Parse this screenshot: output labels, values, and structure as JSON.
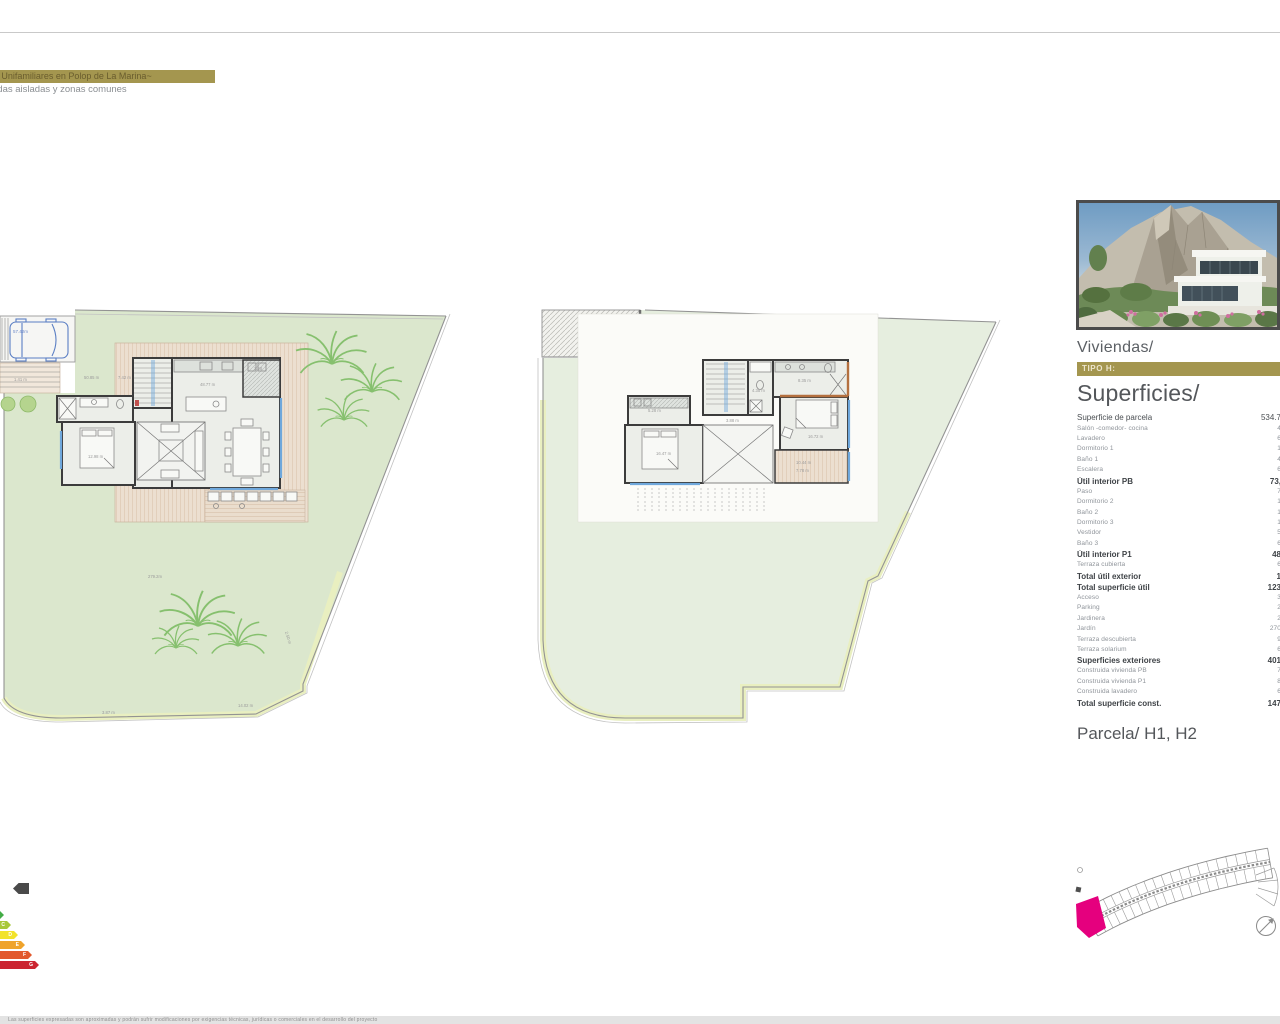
{
  "header": {
    "line1": "Viviendas Unifamiliares en Polop de La Marina~",
    "line2": "viviendas  aisladas y zonas comunes"
  },
  "panel": {
    "viviendas": "Viviendas/",
    "tipo": "TIPO H:",
    "superficies": "Superficies/",
    "parcela": "Parcela/ H1, H2",
    "rows": [
      {
        "label": "Superficie de parcela",
        "value": "534.7"
      },
      {
        "label": "Salón -comedor- cocina",
        "value": "4"
      },
      {
        "label": "Lavadero",
        "value": "6"
      },
      {
        "label": "Dormitorio 1",
        "value": "1"
      },
      {
        "label": "Baño 1",
        "value": "4"
      },
      {
        "label": "Escalera",
        "value": "6"
      },
      {
        "label": "Útil interior PB",
        "value": "73,"
      },
      {
        "label": "Paso",
        "value": "7"
      },
      {
        "label": "Dormitorio 2",
        "value": "1"
      },
      {
        "label": "Baño 2",
        "value": "1"
      },
      {
        "label": "Dormitorio 3",
        "value": "1"
      },
      {
        "label": "Vestidor",
        "value": "5"
      },
      {
        "label": "Baño 3",
        "value": "6"
      },
      {
        "label": "Útil interior P1",
        "value": "48"
      },
      {
        "label": "Terraza cubierta",
        "value": "6"
      },
      {
        "label": "Total útil exterior",
        "value": "1"
      },
      {
        "label": "Total superficie útil",
        "value": "123"
      },
      {
        "label": "Acceso",
        "value": "3"
      },
      {
        "label": "Parking",
        "value": "2"
      },
      {
        "label": "Jardinera",
        "value": "2"
      },
      {
        "label": "Jardín",
        "value": "270"
      },
      {
        "label": "Terraza descubierta",
        "value": "9"
      },
      {
        "label": "Terraza solarium",
        "value": "6"
      },
      {
        "label": "Superficies exteriores",
        "value": "401"
      },
      {
        "label": "Construida vivienda PB",
        "value": "7"
      },
      {
        "label": "Construida vivienda P1",
        "value": "8"
      },
      {
        "label": "Construida lavadero",
        "value": "6"
      },
      {
        "label": "Total superficie const.",
        "value": "147"
      }
    ]
  },
  "plans": {
    "pb": {
      "name": "planta-baja",
      "labels": [
        "57.42m",
        "1.41 m",
        "50.85 m",
        "7.42 m",
        "3.28",
        "48.77 m",
        "12.98 m",
        "279.2m",
        "2.50 m",
        "3.87 m",
        "14.02 m"
      ]
    },
    "p1": {
      "name": "planta-primera",
      "labels": [
        "5.28 m",
        "4.35 m",
        "8.35 m",
        "3.88 m",
        "16.47 m",
        "16.72 m",
        "10.44 m",
        "7.78 m"
      ]
    }
  },
  "energy": {
    "letters": [
      "B",
      "C",
      "D",
      "E",
      "F",
      "G"
    ],
    "colors": [
      "#42ac46",
      "#a8c83b",
      "#f2e32b",
      "#efa32b",
      "#e2582c",
      "#cb2430"
    ],
    "indicator_color": "#4a4a4a"
  },
  "colors": {
    "gold": "#a4964f",
    "lawn_pb": "#dbe7cd",
    "lawn_p1": "#e6eedf",
    "path_strip": "#e9efc0",
    "deck": "#ecdfd0",
    "wall": "#3c3c3c",
    "glazing": "#6fa8dc",
    "palm": "#86c06e",
    "parcel_highlight": "#e5007e"
  },
  "footer": {
    "microtext": "Las superficies expresadas son aproximadas y podrán sufrir modificaciones por exigencias técnicas, jurídicas o comerciales en el desarrollo del proyecto"
  }
}
